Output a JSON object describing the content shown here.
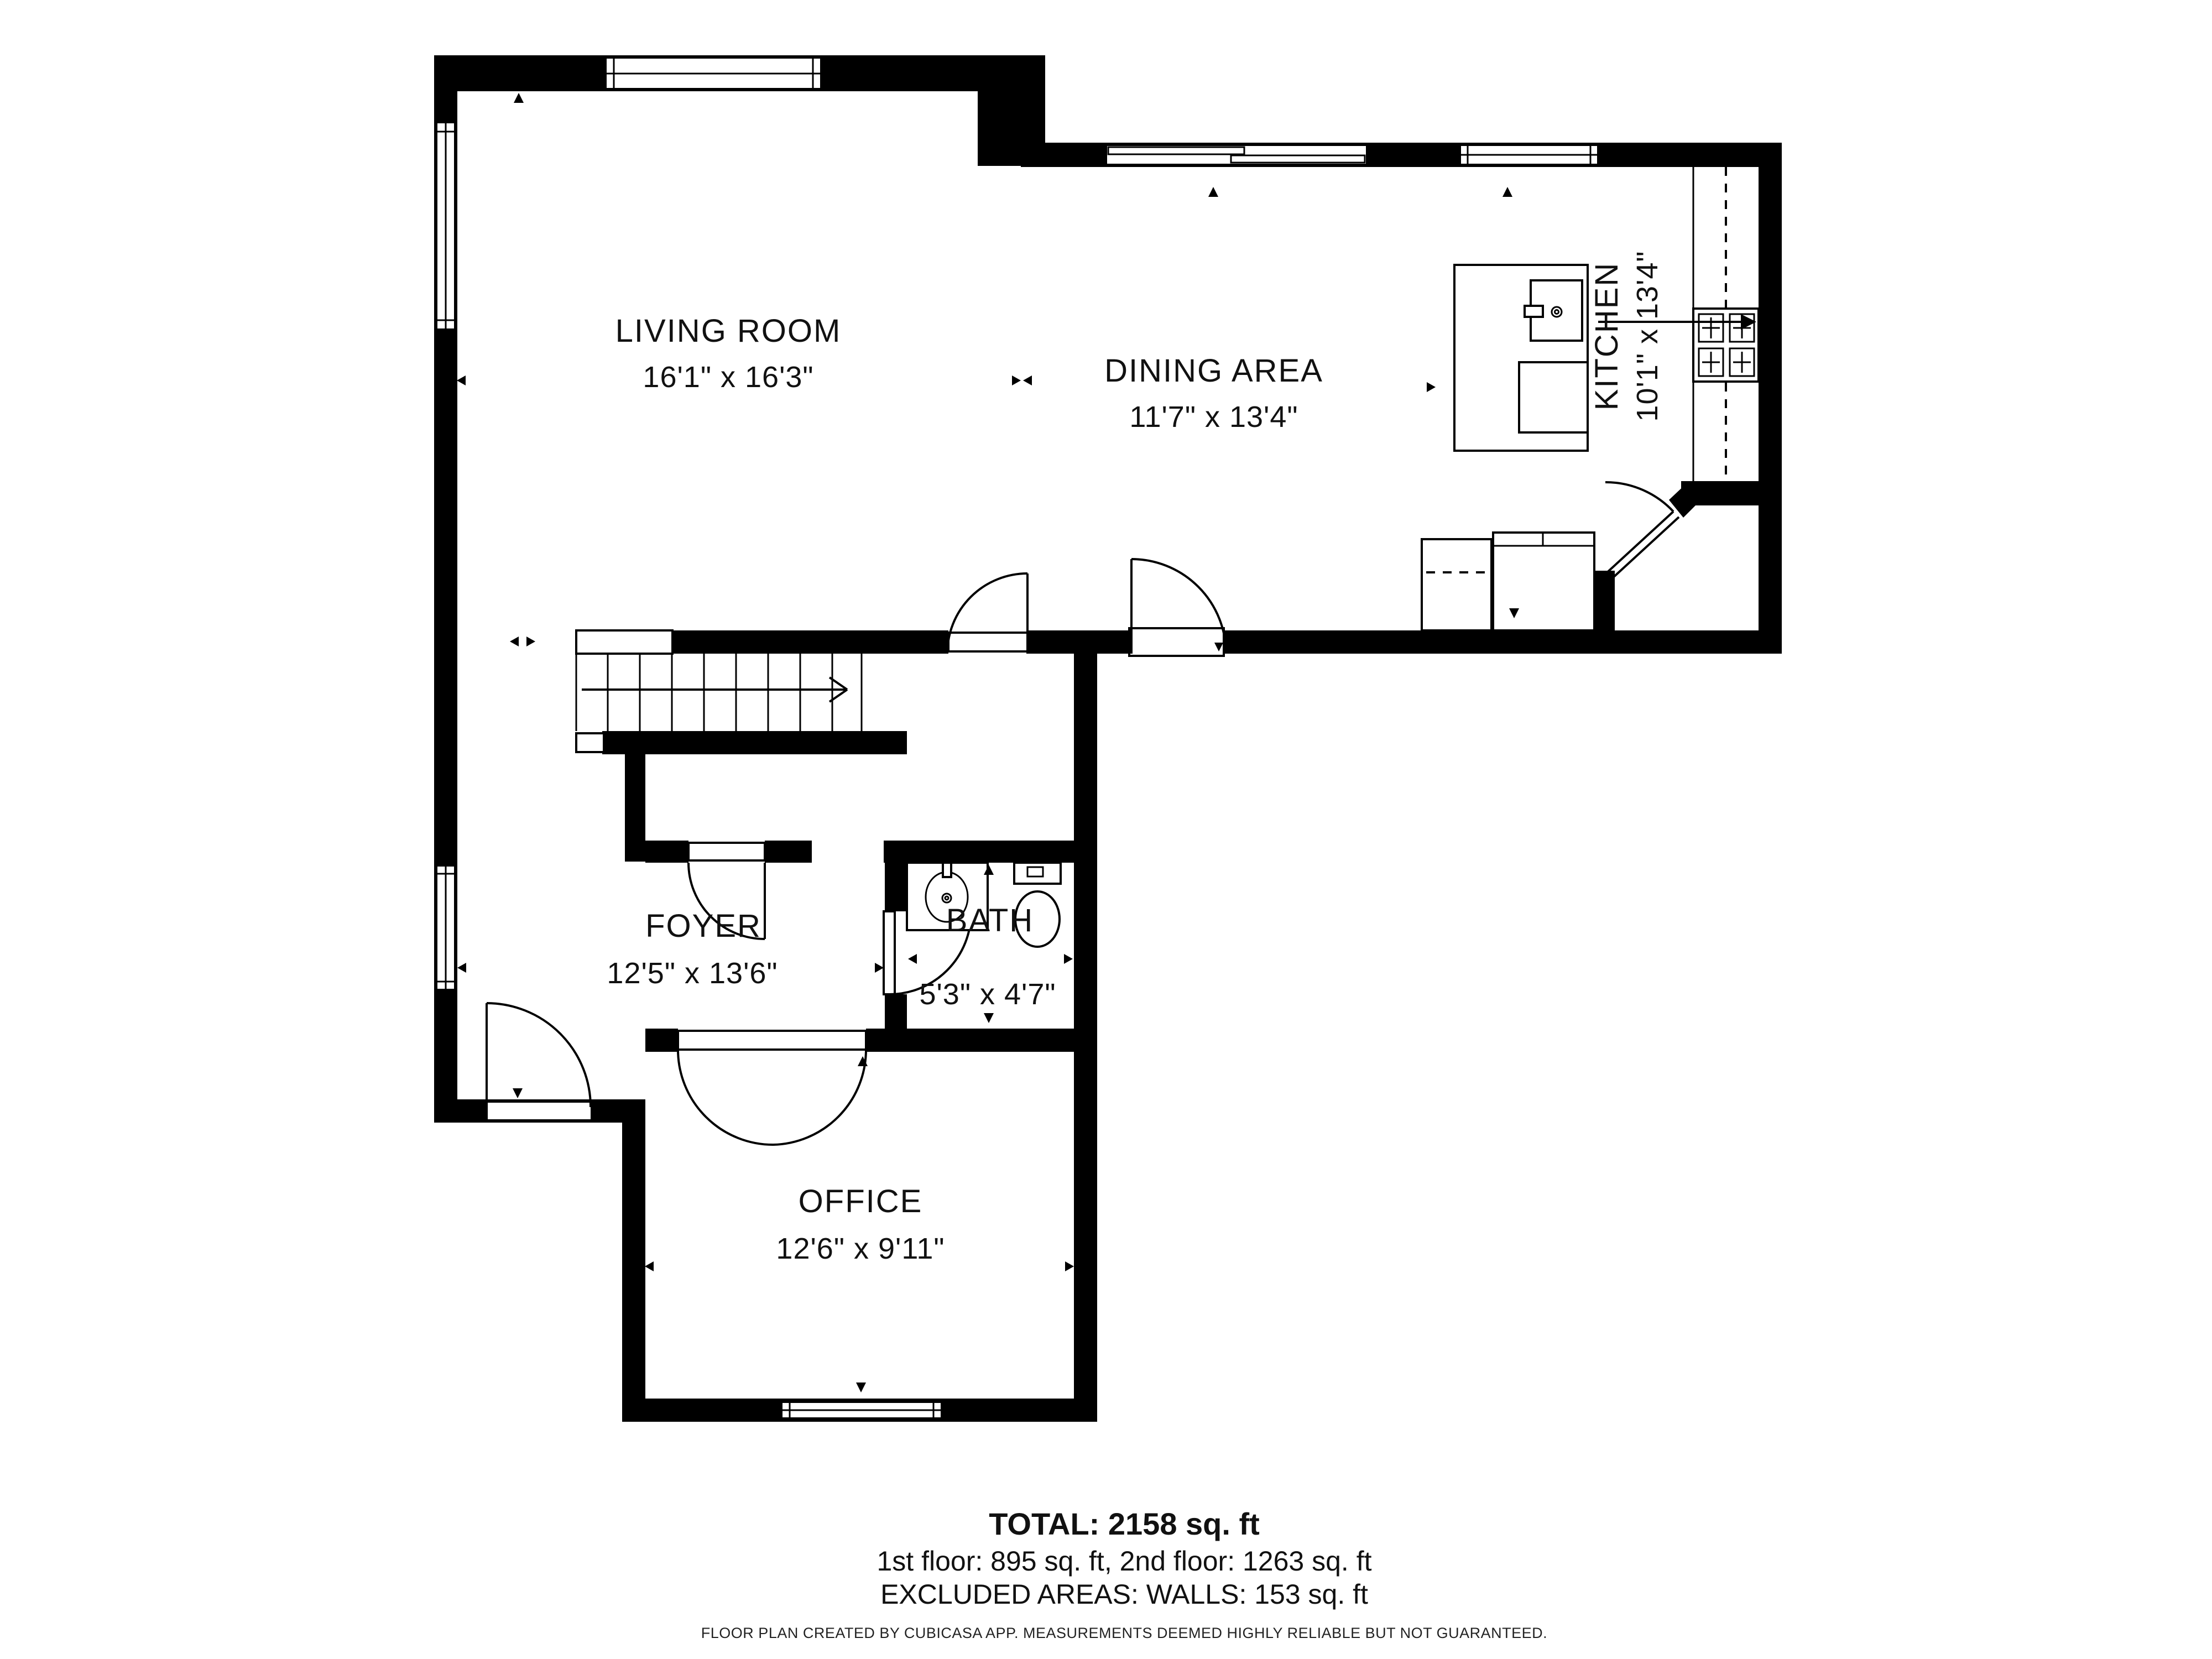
{
  "rooms": [
    {
      "name": "LIVING ROOM",
      "dims": "16'1\" x 16'3\""
    },
    {
      "name": "DINING AREA",
      "dims": "11'7\" x 13'4\""
    },
    {
      "name": "KITCHEN",
      "dims": "10'1\" x 13'4\""
    },
    {
      "name": "FOYER",
      "dims": "12'5\" x 13'6\""
    },
    {
      "name": "BATH",
      "dims": "5'3\" x 4'7\""
    },
    {
      "name": "OFFICE",
      "dims": "12'6\" x 9'11\""
    }
  ],
  "summary": {
    "total": "TOTAL: 2158 sq. ft",
    "floors": "1st floor: 895 sq. ft, 2nd floor: 1263 sq. ft",
    "excluded": "EXCLUDED AREAS: WALLS: 153 sq. ft"
  },
  "footer": {
    "disclaimer": "FLOOR PLAN CREATED BY CUBICASA APP. MEASUREMENTS DEEMED HIGHLY RELIABLE BUT NOT GUARANTEED."
  },
  "colors": {
    "wall": "#000000",
    "background": "#ffffff",
    "text": "#111111"
  }
}
